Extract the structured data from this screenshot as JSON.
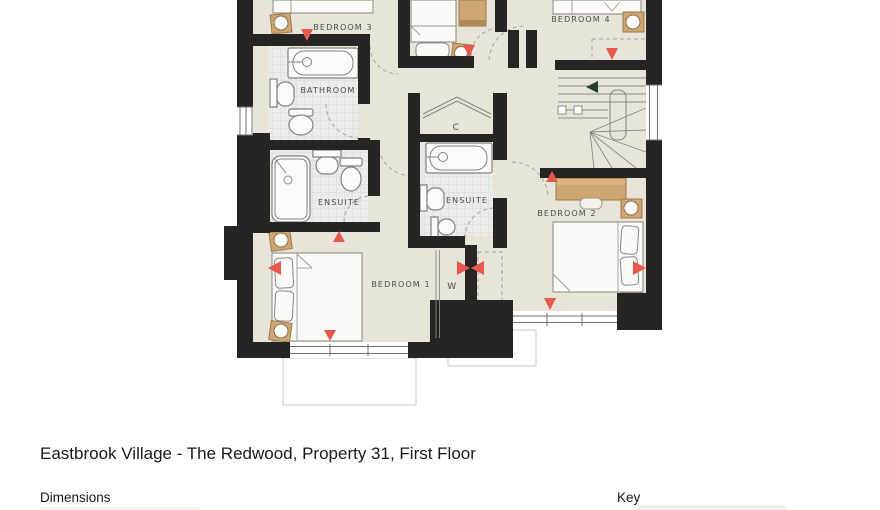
{
  "title": "Eastbrook Village - The Redwood, Property 31, First Floor",
  "sections": {
    "dimensions_label": "Dimensions",
    "key_label": "Key"
  },
  "floorplan": {
    "rooms": {
      "bedroom1": "BEDROOM 1",
      "bedroom2": "BEDROOM 2",
      "bedroom3": "BEDROOM 3",
      "bedroom4": "BEDROOM 4",
      "bathroom": "BATHROOM",
      "ensuite_a": "ENSUITE",
      "ensuite_b": "ENSUITE",
      "cupboard": "C",
      "wardrobe": "W"
    },
    "colors": {
      "wall": "#262523",
      "floor": "#e9e4d9",
      "tile": "#ebebe7",
      "tile_line": "#d8d8d2",
      "wood": "#cfa671",
      "wood_dark": "#b08a52",
      "marker": "#e8584e",
      "stairs_arrow": "#24402f",
      "fixture_stroke": "#83837c",
      "dashed": "#a3a39b",
      "canopy_stroke": "#c8c8c2",
      "label": "#4b4b47"
    }
  }
}
